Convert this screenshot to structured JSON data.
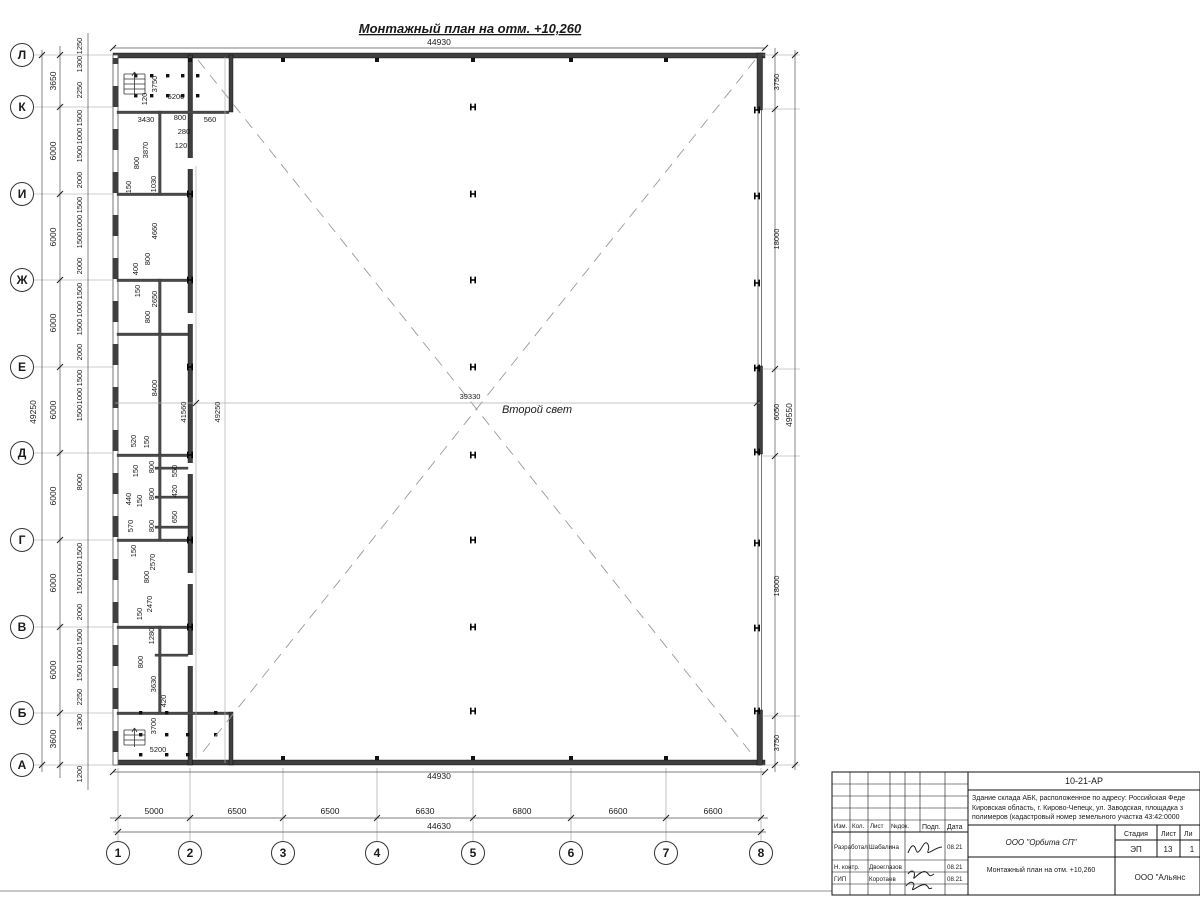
{
  "title": "Монтажный план на отм. +10,260",
  "hall": {
    "room_label": "Второй свет",
    "width_dim": "39330",
    "interior_dim_a": "41560",
    "interior_dim_b": "49250"
  },
  "dims": {
    "top_overall": "44930",
    "bottom_overall": "44930",
    "bottom_total": "44630",
    "left_total": "49250",
    "right_total": "49550",
    "row_spacing": [
      "3650",
      "6000",
      "6000",
      "6000",
      "6000",
      "6000",
      "6000",
      "6000",
      "3600"
    ],
    "col_spacing": [
      "5000",
      "6500",
      "6500",
      "6630",
      "6800",
      "6600",
      "6600"
    ],
    "right_spacing": [
      "3750",
      "18000",
      "6050",
      "18000",
      "3750"
    ],
    "left_fine": [
      "1250",
      "1300",
      "2250",
      "1500",
      "1000",
      "1500",
      "2000",
      "1500",
      "1000",
      "1500",
      "2000",
      "1500",
      "1000",
      "1500",
      "2000",
      "1500",
      "1000",
      "1500",
      "8000",
      "1500",
      "1000",
      "1500",
      "2000",
      "1500",
      "1000",
      "1500",
      "2250",
      "1300",
      "1200"
    ],
    "strip": [
      "3750",
      "5200",
      "120",
      "3430",
      "800",
      "560",
      "280",
      "120",
      "3870",
      "800",
      "150",
      "1030",
      "4660",
      "800",
      "400",
      "150",
      "2650",
      "800",
      "8400",
      "41560",
      "49250",
      "520",
      "150",
      "800",
      "150",
      "550",
      "440",
      "150",
      "800",
      "420",
      "570",
      "800",
      "650",
      "150",
      "2570",
      "800",
      "2470",
      "150",
      "1280",
      "800",
      "3630",
      "420",
      "3700",
      "5200"
    ]
  },
  "grid": {
    "rows": [
      "Л",
      "К",
      "И",
      "Ж",
      "Е",
      "Д",
      "Г",
      "В",
      "Б",
      "А"
    ],
    "cols": [
      "1",
      "2",
      "3",
      "4",
      "5",
      "6",
      "7",
      "8"
    ]
  },
  "titleblock": {
    "doc_number": "10-21-АР",
    "description_line1": "Здание склада АБК, расположенное по адресу: Российская Феде",
    "description_line2": "Кировская область, г. Кирово-Чепецк, ул. Заводская, площадка з",
    "description_line3": "полимеров (кадастровый номер земельного участка 43:42:0000",
    "org": "ООО \"Орбита СП\"",
    "sheet_title": "Монтажный план на отм. +10,260",
    "org2": "ООО \"Альянс",
    "stage_label": "Стадия",
    "sheet_label": "Лист",
    "sheets_label": "Ли",
    "stage": "ЭП",
    "sheet": "13",
    "sheets": "1",
    "header": {
      "izm": "Изм.",
      "kol": "Кол.",
      "list": "Лист",
      "ndoc": "№док.",
      "podp": "Подп.",
      "data": "Дата"
    },
    "rows": [
      {
        "role": "Разработал",
        "name": "Шабалина",
        "date": "08.21"
      },
      {
        "role": "Н. контр.",
        "name": "Двоеглазов",
        "date": "08.21"
      },
      {
        "role": "ГИП",
        "name": "Коротаев",
        "date": "08.21"
      }
    ]
  }
}
